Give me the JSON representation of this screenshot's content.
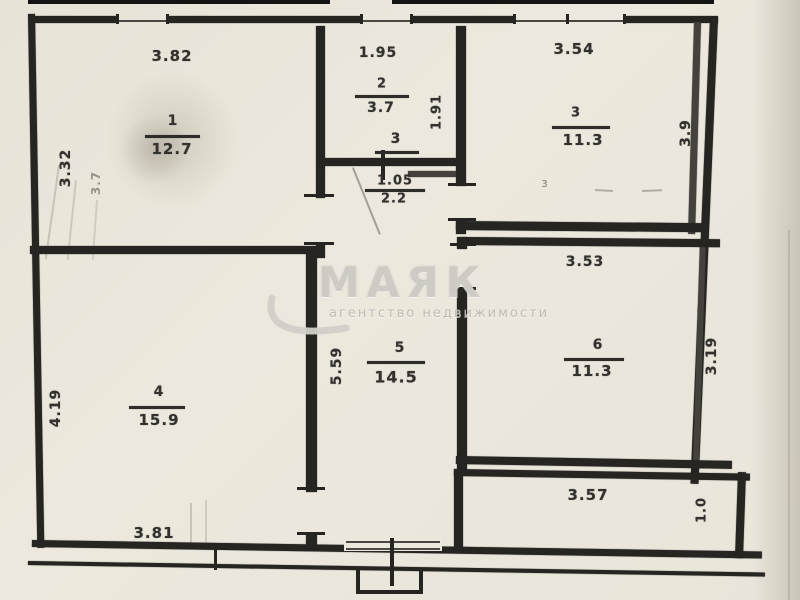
{
  "plan": {
    "type": "floor-plan",
    "rooms": {
      "room1": {
        "number": "1",
        "area": "12.7",
        "width": "3.82",
        "height": "3.32",
        "ghost_dim": "3.7"
      },
      "room2": {
        "number": "2",
        "area": "3.7",
        "width": "1.95",
        "height": "1.91"
      },
      "hall": {
        "number": "3",
        "dim1": "1.05",
        "dim2": "2.2"
      },
      "room3": {
        "number": "3",
        "area": "11.3",
        "width": "3.54",
        "height": "3.9",
        "mark": "з"
      },
      "room4": {
        "number": "4",
        "area": "15.9",
        "width": "3.81",
        "height": "4.19"
      },
      "room5": {
        "number": "5",
        "area": "14.5",
        "height": "5.59"
      },
      "room6": {
        "number": "6",
        "area": "11.3",
        "width": "3.53",
        "height": "3.19"
      },
      "balcony": {
        "width": "3.57",
        "height": "1.0"
      }
    },
    "watermark": {
      "title": "МАЯК",
      "subtitle": "агентство недвижимости"
    },
    "colors": {
      "paper": "#eae6db",
      "ink": "#262522",
      "watermark": "#cbc8c1"
    }
  }
}
